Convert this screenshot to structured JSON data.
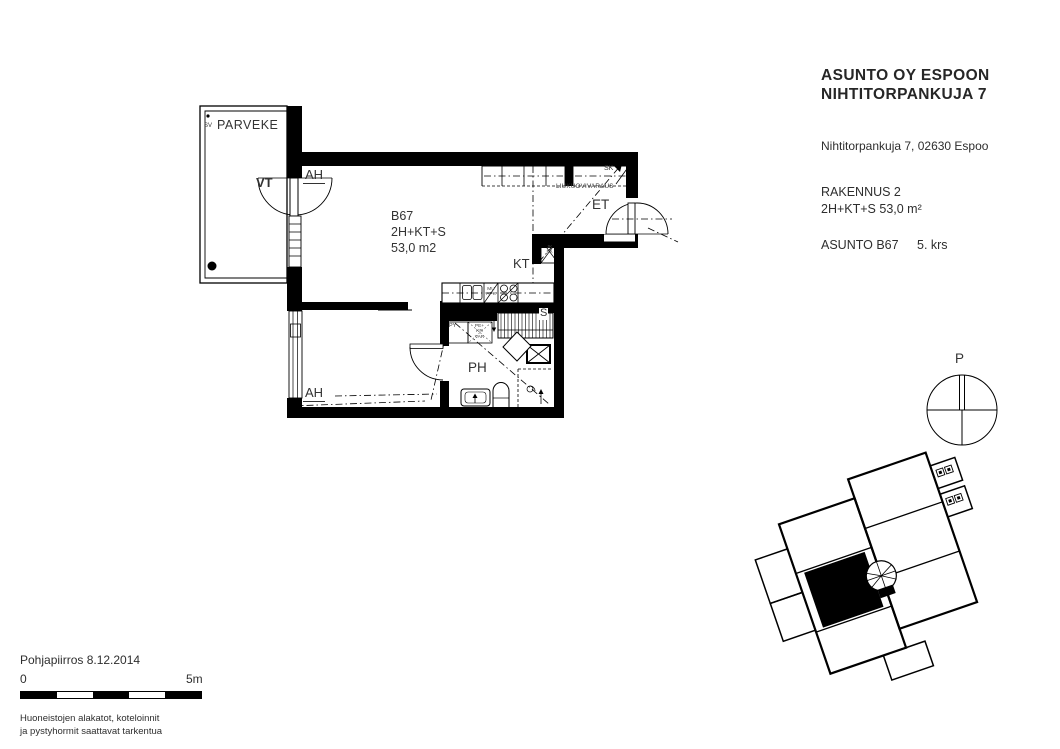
{
  "title_block": {
    "company_line1": "ASUNTO OY ESPOON",
    "company_line2": "NIHTITORPANKUJA 7",
    "address": "Nihtitorpankuja 7, 02630 Espoo",
    "building": "RAKENNUS 2",
    "apartment_type": "2H+KT+S 53,0 m²",
    "apartment_id": "ASUNTO B67",
    "floor": "5. krs"
  },
  "plan": {
    "balcony": "PARVEKE",
    "balcony_code": "SV",
    "balcony_door": "VT",
    "room_upper": "AH",
    "room_lower": "AH",
    "unit_id": "B67",
    "unit_type": "2H+KT+S",
    "unit_area": "53,0 m2",
    "kitchen": "KT",
    "entry": "ET",
    "bathroom": "PH",
    "sauna": "S",
    "closet": "SK",
    "sliding_door_note": "LIUKUOVIVARAUS",
    "laundry_cabinet": "PY",
    "washer_l1": "PE+",
    "washer_l2": "KR",
    "washer_l3": "VAR",
    "appliance_l1": "MU",
    "appliance_l2": "APK",
    "fridge_l1": "JK",
    "fridge_l2": "PA"
  },
  "compass": {
    "north": "P"
  },
  "footer": {
    "document_title": "Pohjapiirros 8.12.2014",
    "scale_start": "0",
    "scale_end": "5m",
    "note_line1": "Huoneistojen alakatot, koteloinnit",
    "note_line2": "ja pystyhormit saattavat tarkentua"
  }
}
